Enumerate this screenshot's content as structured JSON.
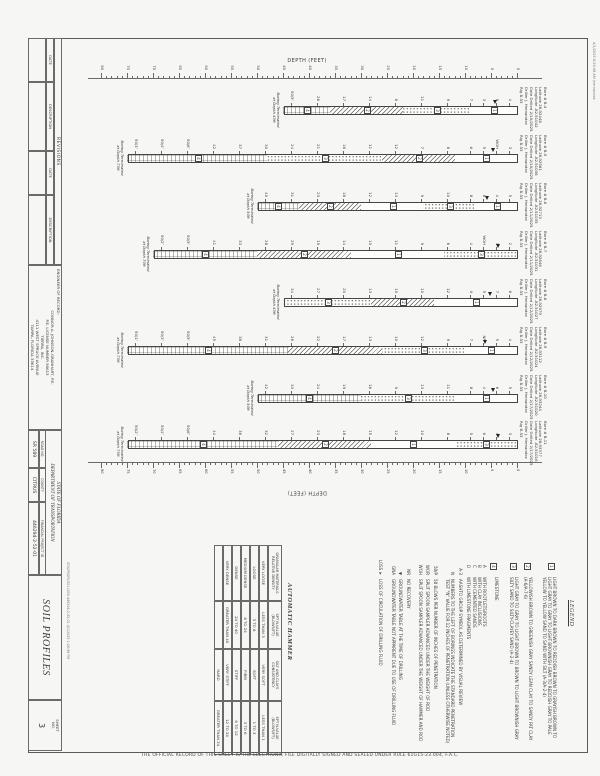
{
  "meta": {
    "disclaimer": "THE OFFICIAL RECORD OF THIS SHEET IS THE ELECTRONIC FILE DIGITALLY SIGNED AND SEALED UNDER RULE 61G15-23.004, F.A.C.",
    "print_stamp": "4/1/2025 8:26:48 AM  jhernandez",
    "file_stamp": "SOILPROFILE01.DGN  446294-2-52-01  4/1/2025 1:26:58 PM"
  },
  "title_block": {
    "revisions_label": "REVISIONS",
    "date_label": "DATE",
    "description_label": "DESCRIPTION",
    "engineer": {
      "header": "ENGINEER OF RECORD:",
      "lines": [
        "CONNOR A. JOHNSON-GRANHART, P.E.",
        "P.E. LICENSE NUMBER 90613",
        "TIERRA, INC.",
        "4111 WEST SPRUCE AVENUE",
        "TAMPA, FLORIDA 33614"
      ]
    },
    "dot": {
      "state": "STATE OF FLORIDA",
      "dept": "DEPARTMENT OF TRANSPORTATION",
      "road_no_label": "ROAD NO.",
      "road_no": "SR 589",
      "county_label": "COUNTY",
      "county": "CITRUS",
      "fpid_label": "FINANCIAL PROJECT ID",
      "fpid": "446294-2-52-01"
    },
    "sheet_title": "SOIL PROFILES",
    "sheet_no_label": "SHEET\nNO.",
    "sheet_no": "3"
  },
  "axis": {
    "label": "DEPTH (FEET)",
    "min": 0,
    "max": 80,
    "label_step": 5,
    "y0": 82,
    "px_per_ft": 5.2,
    "x_left": 78,
    "x_right": 462
  },
  "legend": {
    "title": "LEGEND",
    "items": [
      {
        "num": "1",
        "text": "LIGHT BROWN TO DARK BROWN TO REDDISH BROWN TO GRAYISH BROWN TO LIGHT GRAY TO GRAY TO LIGHT BROWNISH GRAY TO REDDISH GRAY TO PALE YELLOW TO YELLOW SAND TO SAND WITH SILT (A-3/A-2-4)"
      },
      {
        "num": "2",
        "text": "YELLOWISH BROWN TO GREENISH GRAY SANDY LEAN CLAY TO SANDY FAT CLAY (A-6/A-7-6)"
      },
      {
        "num": "3",
        "text": "LIGHT GRAY TO GRAY TO LIGHT BROWN TO BROWN TO LIGHT BROWNISH GRAY SILTY SAND TO SILTY-CLAYEY SAND (A-2-4)"
      },
      {
        "num": "4",
        "text": "LIMESTONE"
      }
    ],
    "modifiers": [
      {
        "key": "A",
        "text": "WITH ROOTLETS/ROOTS"
      },
      {
        "key": "B",
        "text": "WITH CLAY INCLUSIONS"
      },
      {
        "key": "C",
        "text": "WITH CEMENTED SANDS"
      },
      {
        "key": "D",
        "text": "WITH LIMESTONE FRAGMENTS"
      }
    ],
    "notes": [
      {
        "key": "A-3",
        "text": "AASHTO GROUP SYMBOL AS DETERMINED BY VISUAL REVIEW"
      },
      {
        "key": "N",
        "text": "NUMBERS TO THE LEFT OF BORINGS INDICATE THE STANDARD PENETRATION TEST \"N\" VALUE FOR 12 INCHES OF PENETRATION (UNLESS OTHERWISE NOTED)"
      },
      {
        "key": "50/P",
        "text": "50 BLOWS PER NUMBER OF INCHES OF PENETRATION"
      },
      {
        "key": "WOR",
        "text": "SPLIT SPOON SAMPLER ADVANCED UNDER THE WEIGHT OF ROD"
      },
      {
        "key": "WOH",
        "text": "SPLIT SPOON SAMPLER ADVANCED UNDER THE WEIGHT OF HAMMER AND ROD"
      },
      {
        "key": "NR",
        "text": "NO RECOVERY"
      },
      {
        "key": "▼",
        "text": "GROUNDWATER TABLE AT THE TIME OF DRILLING"
      },
      {
        "key": "GNA",
        "text": "GROUNDWATER TABLE NOT APPARENT DUE TO USE OF DRILLING FLUID"
      },
      {
        "key": "LOSS ➤",
        "text": "LOSS OF CIRCULATION OF DRILLING FLUID"
      }
    ]
  },
  "hammer": {
    "title": "AUTOMATIC HAMMER",
    "headers": [
      "GRANULAR MATERIALS\nRELATIVE DENSITY",
      "SPT N-VALUE\n(BLOWS/FT)",
      "SILT AND CLAYS\nCONSISTENCY",
      "SPT N-VALUE\n(BLOWS/FT)"
    ],
    "rows": [
      [
        "VERY LOOSE",
        "LESS THAN 3",
        "VERY SOFT",
        "LESS THAN 1"
      ],
      [
        "LOOSE",
        "3 TO 8",
        "SOFT",
        "1 TO 3"
      ],
      [
        "MEDIUM DENSE",
        "8 TO 24",
        "FIRM",
        "3 TO 6"
      ],
      [
        "DENSE",
        "24 TO 40",
        "STIFF",
        "6 TO 12"
      ],
      [
        "VERY DENSE",
        "GREATER THAN 40",
        "VERY STIFF",
        "12 TO 24"
      ],
      [
        "",
        "",
        "HARD",
        "GREATER THAN 24"
      ]
    ]
  },
  "borings": [
    {
      "name": "Bore # B-4",
      "lat": "Latitude 28.92448",
      "lon": "Longitude -82.51042",
      "date": "Date Drilled 2/10/2025",
      "driller": "Driller J. Hernandez",
      "rig": "Rig B-53",
      "x": 106,
      "end": 45,
      "gwt": 4.5,
      "note": [
        "Boring Terminated",
        "at Depth 45ft"
      ],
      "strata": [
        [
          0,
          9,
          1
        ],
        [
          9,
          22,
          3
        ],
        [
          22,
          36,
          2
        ],
        [
          36,
          45,
          4
        ]
      ],
      "n": [
        [
          1.5,
          "4"
        ],
        [
          4,
          "5"
        ],
        [
          6.5,
          "3"
        ],
        [
          9,
          "7"
        ],
        [
          13.5,
          "9"
        ],
        [
          18.5,
          "11"
        ],
        [
          23.5,
          "8"
        ],
        [
          28.5,
          "14"
        ],
        [
          33.5,
          "17"
        ],
        [
          38.5,
          "26"
        ],
        [
          43.5,
          "50/5″"
        ]
      ]
    },
    {
      "name": "Bore # B-5",
      "lat": "Latitude 28.92581",
      "lon": "Longitude -82.51038",
      "date": "Date Drilled 2/10/2025",
      "driller": "Driller J. Hernandez",
      "rig": "Rig B-53",
      "x": 154,
      "end": 75,
      "gwt": 5,
      "note": [
        "Boring Terminated",
        "at Depth 75ft"
      ],
      "strata": [
        [
          0,
          12,
          1
        ],
        [
          12,
          26,
          2
        ],
        [
          26,
          48,
          3
        ],
        [
          48,
          75,
          4
        ]
      ],
      "n": [
        [
          1.5,
          "3"
        ],
        [
          4,
          "WOH"
        ],
        [
          6.5,
          "5"
        ],
        [
          9,
          "6"
        ],
        [
          13.5,
          "8"
        ],
        [
          18.5,
          "7"
        ],
        [
          23.5,
          "12"
        ],
        [
          28.5,
          "11"
        ],
        [
          33.5,
          "16"
        ],
        [
          38.5,
          "21"
        ],
        [
          43.5,
          "24"
        ],
        [
          48.5,
          "30"
        ],
        [
          53.5,
          "37"
        ],
        [
          58.5,
          "42"
        ],
        [
          63.5,
          "50/6″"
        ],
        [
          68.5,
          "50/4″"
        ],
        [
          73.5,
          "50/3″"
        ]
      ]
    },
    {
      "name": "Bore # B-6",
      "lat": "Latitude 28.92713",
      "lon": "Longitude -82.51035",
      "date": "Date Drilled 2/11/2025",
      "driller": "Driller J. Hernandez",
      "rig": "Rig B-53",
      "x": 202,
      "end": 50,
      "gwt": 6,
      "note": [
        "Boring Terminated",
        "at Depth 50ft"
      ],
      "strata": [
        [
          0,
          8,
          1
        ],
        [
          8,
          18,
          3
        ],
        [
          18,
          30,
          1
        ],
        [
          30,
          42,
          2
        ],
        [
          42,
          50,
          4
        ]
      ],
      "n": [
        [
          1.5,
          "5"
        ],
        [
          4,
          "4"
        ],
        [
          6.5,
          "6"
        ],
        [
          9,
          "8"
        ],
        [
          13.5,
          "10"
        ],
        [
          18.5,
          "9"
        ],
        [
          23.5,
          "13"
        ],
        [
          28.5,
          "12"
        ],
        [
          33.5,
          "18"
        ],
        [
          38.5,
          "23"
        ],
        [
          43.5,
          "31"
        ],
        [
          48.5,
          "40"
        ]
      ]
    },
    {
      "name": "Bore # B-7",
      "lat": "Latitude 28.92846",
      "lon": "Longitude -82.51031",
      "date": "Date Drilled 2/11/2025",
      "driller": "Driller J. Hernandez",
      "rig": "Rig B-53",
      "x": 250,
      "end": 70,
      "gwt": 4,
      "note": [
        "Boring Terminated",
        "at Depth 70ft"
      ],
      "strata": [
        [
          0,
          14,
          3
        ],
        [
          14,
          32,
          1
        ],
        [
          32,
          50,
          2
        ],
        [
          50,
          70,
          4
        ]
      ],
      "n": [
        [
          1.5,
          "2"
        ],
        [
          4,
          "3"
        ],
        [
          6.5,
          "WOH"
        ],
        [
          9,
          "4"
        ],
        [
          13.5,
          "6"
        ],
        [
          18.5,
          "9"
        ],
        [
          23.5,
          "11"
        ],
        [
          28.5,
          "10"
        ],
        [
          33.5,
          "14"
        ],
        [
          38.5,
          "19"
        ],
        [
          43.5,
          "25"
        ],
        [
          48.5,
          "28"
        ],
        [
          53.5,
          "33"
        ],
        [
          58.5,
          "41"
        ],
        [
          63.5,
          "50/5″"
        ],
        [
          68.5,
          "50/2″"
        ]
      ]
    },
    {
      "name": "Bore # B-8",
      "lat": "Latitude 28.92979",
      "lon": "Longitude -82.51027",
      "date": "Date Drilled 2/12/2025",
      "driller": "Driller J. Hernandez",
      "rig": "Rig B-53",
      "x": 298,
      "end": 45,
      "gwt": 5.5,
      "note": [
        "Boring Terminated",
        "at Depth 45ft"
      ],
      "strata": [
        [
          0,
          16,
          1
        ],
        [
          16,
          28,
          2
        ],
        [
          28,
          45,
          3
        ]
      ],
      "n": [
        [
          1.5,
          "6"
        ],
        [
          4,
          "7"
        ],
        [
          6.5,
          "5"
        ],
        [
          9,
          "9"
        ],
        [
          13.5,
          "12"
        ],
        [
          18.5,
          "10"
        ],
        [
          23.5,
          "15"
        ],
        [
          28.5,
          "13"
        ],
        [
          33.5,
          "20"
        ],
        [
          38.5,
          "27"
        ],
        [
          43.5,
          "34"
        ]
      ]
    },
    {
      "name": "Bore # B-9",
      "lat": "Latitude 28.93112",
      "lon": "Longitude -82.51024",
      "date": "Date Drilled 2/12/2025",
      "driller": "Driller J. Hernandez",
      "rig": "Rig B-53",
      "x": 346,
      "end": 75,
      "gwt": 6.5,
      "note": [
        "Boring Terminated",
        "at Depth 75ft"
      ],
      "strata": [
        [
          0,
          10,
          1
        ],
        [
          10,
          26,
          3
        ],
        [
          26,
          44,
          2
        ],
        [
          44,
          75,
          4
        ]
      ],
      "n": [
        [
          1.5,
          "4"
        ],
        [
          4,
          "5"
        ],
        [
          6.5,
          "NR"
        ],
        [
          9,
          "7"
        ],
        [
          13.5,
          "9"
        ],
        [
          18.5,
          "12"
        ],
        [
          23.5,
          "10"
        ],
        [
          28.5,
          "13"
        ],
        [
          33.5,
          "17"
        ],
        [
          38.5,
          "22"
        ],
        [
          43.5,
          "28"
        ],
        [
          48.5,
          "31"
        ],
        [
          53.5,
          "38"
        ],
        [
          58.5,
          "45"
        ],
        [
          63.5,
          "50/5″"
        ],
        [
          68.5,
          "50/3″"
        ],
        [
          73.5,
          "50/1″"
        ]
      ]
    },
    {
      "name": "Bore # B-10",
      "lat": "Latitude 28.93244",
      "lon": "Longitude -82.51020",
      "date": "Date Drilled 2/17/2025",
      "driller": "Driller J. Hernandez",
      "rig": "Rig B-53",
      "x": 394,
      "end": 50,
      "gwt": 5,
      "note": [
        "Boring Terminated",
        "at Depth 50ft"
      ],
      "strata": [
        [
          0,
          12,
          1
        ],
        [
          12,
          30,
          3
        ],
        [
          30,
          50,
          4
        ]
      ],
      "n": [
        [
          1.5,
          "5"
        ],
        [
          4,
          "6"
        ],
        [
          6.5,
          "4"
        ],
        [
          9,
          "8"
        ],
        [
          13.5,
          "11"
        ],
        [
          18.5,
          "13"
        ],
        [
          23.5,
          "9"
        ],
        [
          28.5,
          "16"
        ],
        [
          33.5,
          "19"
        ],
        [
          38.5,
          "24"
        ],
        [
          43.5,
          "33"
        ],
        [
          48.5,
          "42"
        ]
      ]
    },
    {
      "name": "Bore # B-11",
      "lat": "Latitude 28.93377",
      "lon": "Longitude -82.51016",
      "date": "Date Drilled 2/17/2025",
      "driller": "Driller J. Hernandez",
      "rig": "Rig B-53",
      "x": 440,
      "end": 75,
      "gwt": 4,
      "note": [
        "Boring Terminated",
        "at Depth 75ft"
      ],
      "strata": [
        [
          0,
          12,
          3
        ],
        [
          12,
          28,
          1
        ],
        [
          28,
          46,
          2
        ],
        [
          46,
          75,
          4
        ]
      ],
      "n": [
        [
          1.5,
          "3"
        ],
        [
          4,
          "4"
        ],
        [
          6.5,
          "6"
        ],
        [
          9,
          "5"
        ],
        [
          13.5,
          "8"
        ],
        [
          18.5,
          "10"
        ],
        [
          23.5,
          "12"
        ],
        [
          28.5,
          "15"
        ],
        [
          33.5,
          "18"
        ],
        [
          38.5,
          "23"
        ],
        [
          43.5,
          "27"
        ],
        [
          48.5,
          "32"
        ],
        [
          53.5,
          "36"
        ],
        [
          58.5,
          "44"
        ],
        [
          63.5,
          "50/6″"
        ],
        [
          68.5,
          "50/4″"
        ],
        [
          73.5,
          "50/2″"
        ]
      ]
    }
  ]
}
